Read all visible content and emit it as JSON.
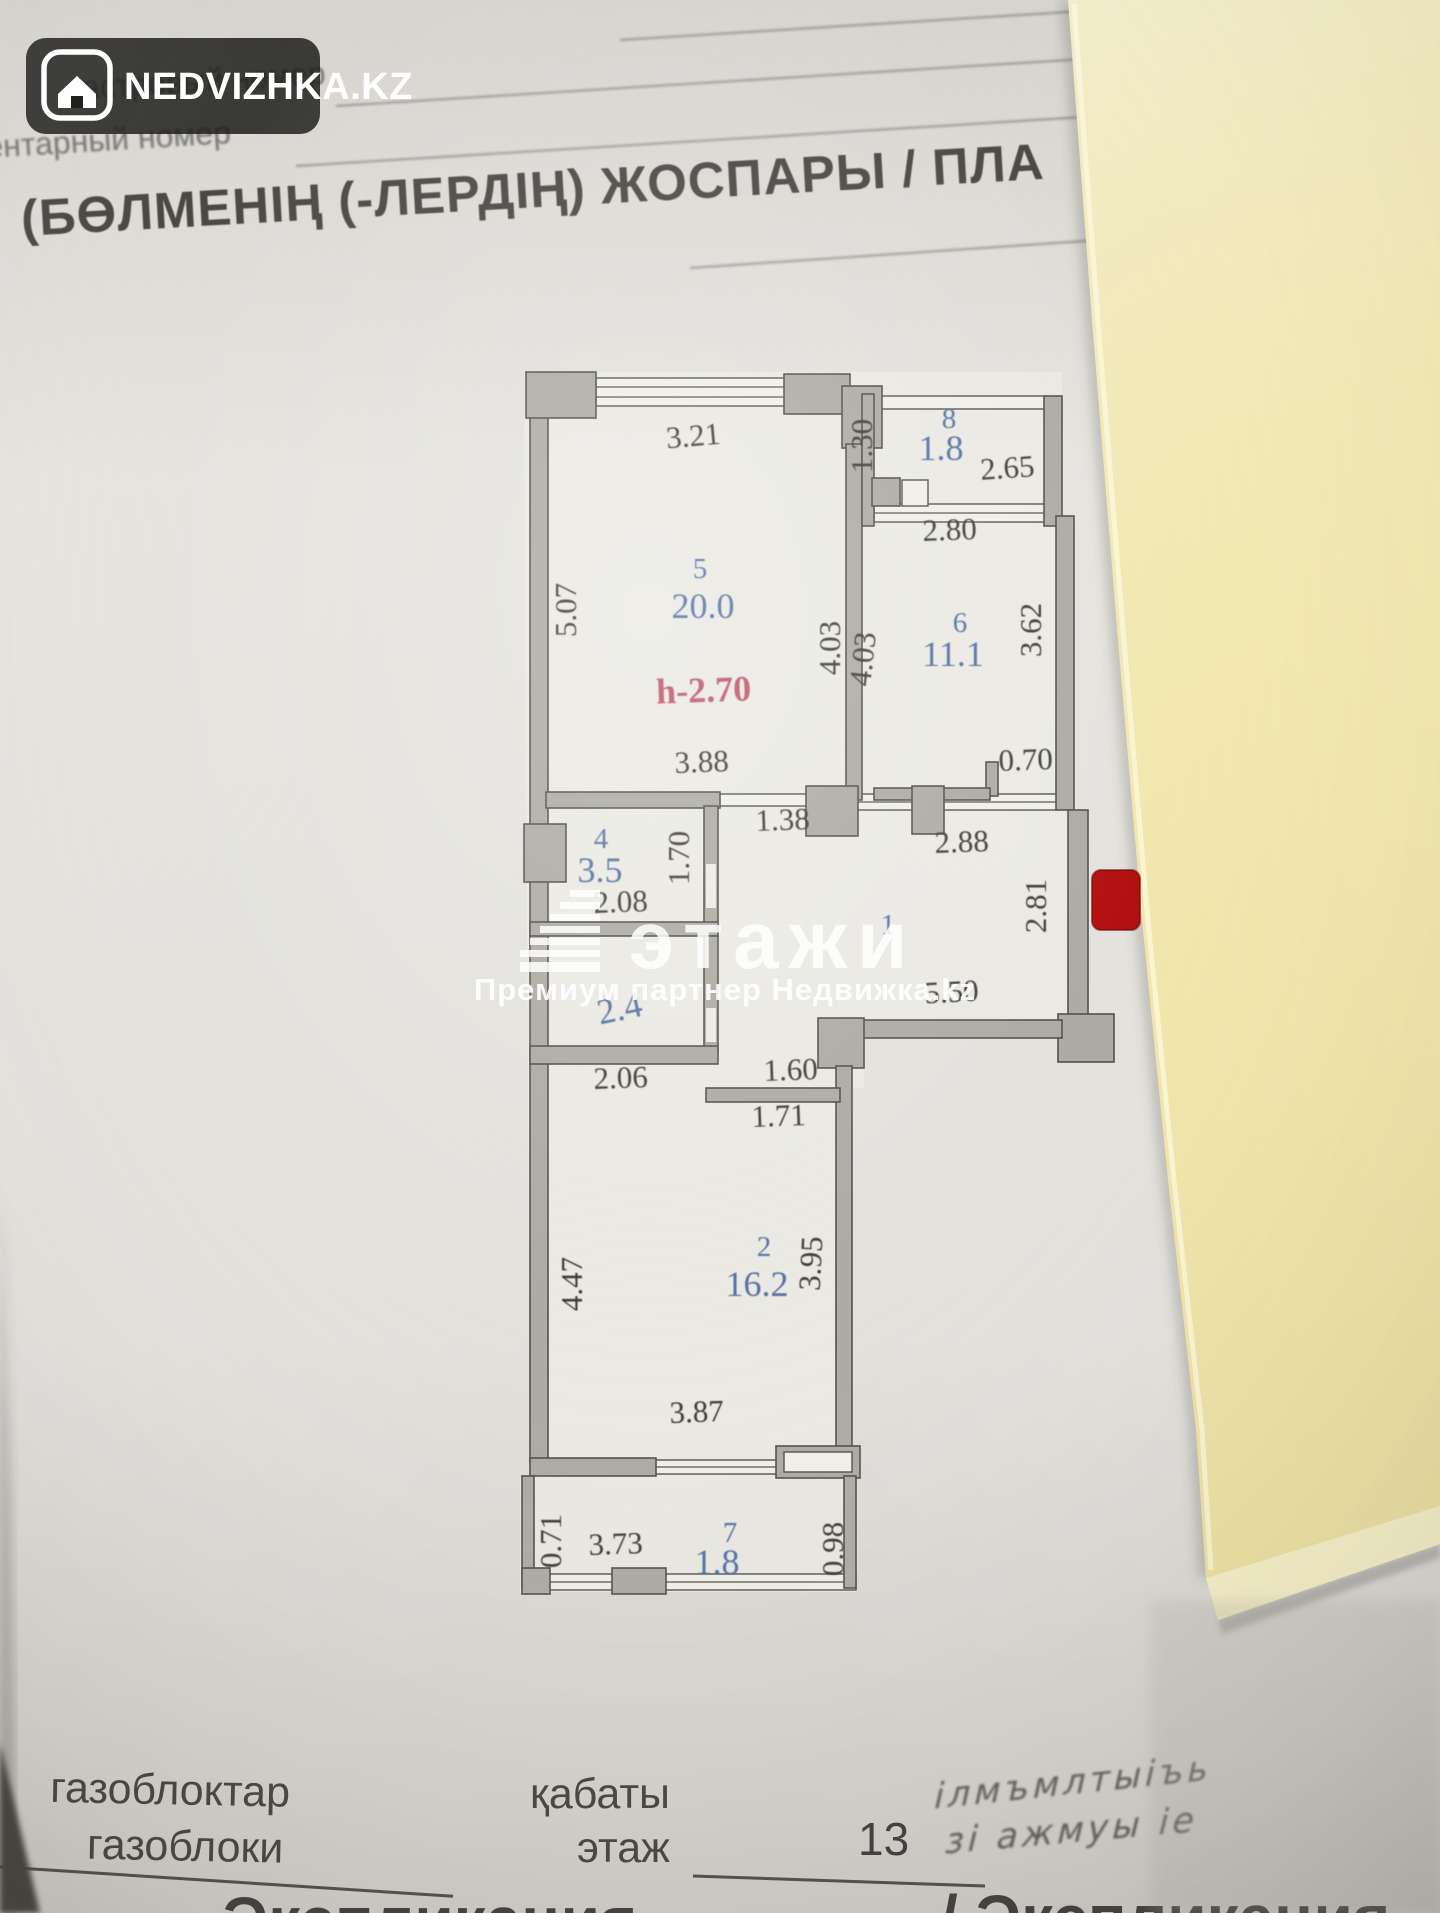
{
  "badge": {
    "brand": "NEDVIZHKA.KZ"
  },
  "header": {
    "faint_line1": "дастровый номер",
    "faint_line2": "ентарный номер",
    "title": "(БӨЛМЕНІҢ (-ЛЕРДІҢ) ЖОСПАРЫ / ПЛА"
  },
  "watermark": {
    "brand": "этажи",
    "subtitle": "Премиум партнер Недвижка.kz"
  },
  "plan": {
    "ceiling_height": "h-2.70",
    "rooms": [
      {
        "number": "5",
        "area": "20.0"
      },
      {
        "number": "6",
        "area": "11.1"
      },
      {
        "number": "8",
        "area": "1.8"
      },
      {
        "number": "4",
        "area": "3.5"
      },
      {
        "number": "3",
        "area": "2.4"
      },
      {
        "number": "1",
        "area": ""
      },
      {
        "number": "2",
        "area": "16.2"
      },
      {
        "number": "7",
        "area": "1.8"
      }
    ],
    "labels": [
      {
        "text": "3.21",
        "x": 694,
        "y": 446,
        "rot": -5,
        "cls": "dim"
      },
      {
        "text": "1.30",
        "x": 872,
        "y": 446,
        "rot": -90,
        "cls": "dim"
      },
      {
        "text": "8",
        "x": 949,
        "y": 428,
        "cls": "room"
      },
      {
        "text": "1.8",
        "x": 941,
        "y": 460,
        "cls": "area",
        "size": 34
      },
      {
        "text": "2.65",
        "x": 1008,
        "y": 478,
        "rot": -4,
        "cls": "dim"
      },
      {
        "text": "2.80",
        "x": 950,
        "y": 540,
        "rot": -2,
        "cls": "dim"
      },
      {
        "text": "5",
        "x": 700,
        "y": 578,
        "cls": "room"
      },
      {
        "text": "20.0",
        "x": 703,
        "y": 618,
        "cls": "area",
        "size": 40
      },
      {
        "text": "5.07",
        "x": 576,
        "y": 610,
        "rot": -90,
        "cls": "dim"
      },
      {
        "text": "4.03",
        "x": 840,
        "y": 648,
        "rot": -90,
        "cls": "dim"
      },
      {
        "text": "4.03",
        "x": 873,
        "y": 660,
        "rot": -84,
        "cls": "dim"
      },
      {
        "text": "6",
        "x": 960,
        "y": 632,
        "cls": "room"
      },
      {
        "text": "11.1",
        "x": 953,
        "y": 666,
        "cls": "area",
        "size": 38
      },
      {
        "text": "3.62",
        "x": 1041,
        "y": 630,
        "rot": -90,
        "cls": "dim"
      },
      {
        "text": "h-2.70",
        "x": 704,
        "y": 702,
        "rot": -2,
        "cls": "height",
        "size": 36
      },
      {
        "text": "3.88",
        "x": 702,
        "y": 772,
        "rot": -2,
        "cls": "dim",
        "size": 34
      },
      {
        "text": "0.70",
        "x": 1026,
        "y": 770,
        "rot": -2,
        "cls": "dim"
      },
      {
        "text": "1.38",
        "x": 783,
        "y": 830,
        "rot": -2,
        "cls": "dim",
        "size": 33
      },
      {
        "text": "2.88",
        "x": 962,
        "y": 852,
        "rot": -2,
        "cls": "dim",
        "size": 34
      },
      {
        "text": "4",
        "x": 601,
        "y": 848,
        "cls": "room"
      },
      {
        "text": "1.70",
        "x": 689,
        "y": 858,
        "rot": -90,
        "cls": "dim"
      },
      {
        "text": "3.5",
        "x": 600,
        "y": 882,
        "cls": "area",
        "size": 36
      },
      {
        "text": "2.08",
        "x": 621,
        "y": 912,
        "rot": -2,
        "cls": "dim"
      },
      {
        "text": "1",
        "x": 888,
        "y": 934,
        "cls": "room",
        "size": 34
      },
      {
        "text": "5.50",
        "x": 952,
        "y": 1002,
        "rot": -3,
        "cls": "dim"
      },
      {
        "text": "2.81",
        "x": 1046,
        "y": 906,
        "rot": -90,
        "cls": "dim"
      },
      {
        "text": "2.4",
        "x": 622,
        "y": 1020,
        "rot": -12,
        "cls": "area",
        "size": 36
      },
      {
        "text": "2.06",
        "x": 621,
        "y": 1088,
        "rot": -2,
        "cls": "dim"
      },
      {
        "text": "1.60",
        "x": 791,
        "y": 1080,
        "rot": -2,
        "cls": "dim"
      },
      {
        "text": "1.71",
        "x": 779,
        "y": 1126,
        "rot": -2,
        "cls": "dim"
      },
      {
        "text": "2",
        "x": 764,
        "y": 1256,
        "cls": "room"
      },
      {
        "text": "16.2",
        "x": 757,
        "y": 1296,
        "cls": "area",
        "size": 40
      },
      {
        "text": "4.47",
        "x": 582,
        "y": 1284,
        "rot": -90,
        "cls": "dim",
        "size": 34
      },
      {
        "text": "3.95",
        "x": 821,
        "y": 1264,
        "rot": -87,
        "cls": "dim",
        "size": 34
      },
      {
        "text": "3.87",
        "x": 697,
        "y": 1422,
        "rot": -2,
        "cls": "dim",
        "size": 34
      },
      {
        "text": "0.71",
        "x": 561,
        "y": 1541,
        "rot": -90,
        "cls": "dim"
      },
      {
        "text": "3.73",
        "x": 616,
        "y": 1554,
        "rot": -2,
        "cls": "dim"
      },
      {
        "text": "7",
        "x": 730,
        "y": 1542,
        "cls": "room"
      },
      {
        "text": "1.8",
        "x": 717,
        "y": 1574,
        "cls": "area",
        "size": 33
      },
      {
        "text": "0.98",
        "x": 843,
        "y": 1549,
        "rot": -90,
        "cls": "dim"
      }
    ]
  },
  "footer": {
    "material_kk": "газоблоктар",
    "material_ru": "газоблоки",
    "floor_kk": "қабаты",
    "floor_ru": "этаж",
    "floor_value": "13",
    "explication_left": "Экспликация",
    "explication_right": "/ Экспликация",
    "handwriting_line1": "ілмъмлтыіъь",
    "handwriting_line2": "зі ажмуы іе"
  }
}
